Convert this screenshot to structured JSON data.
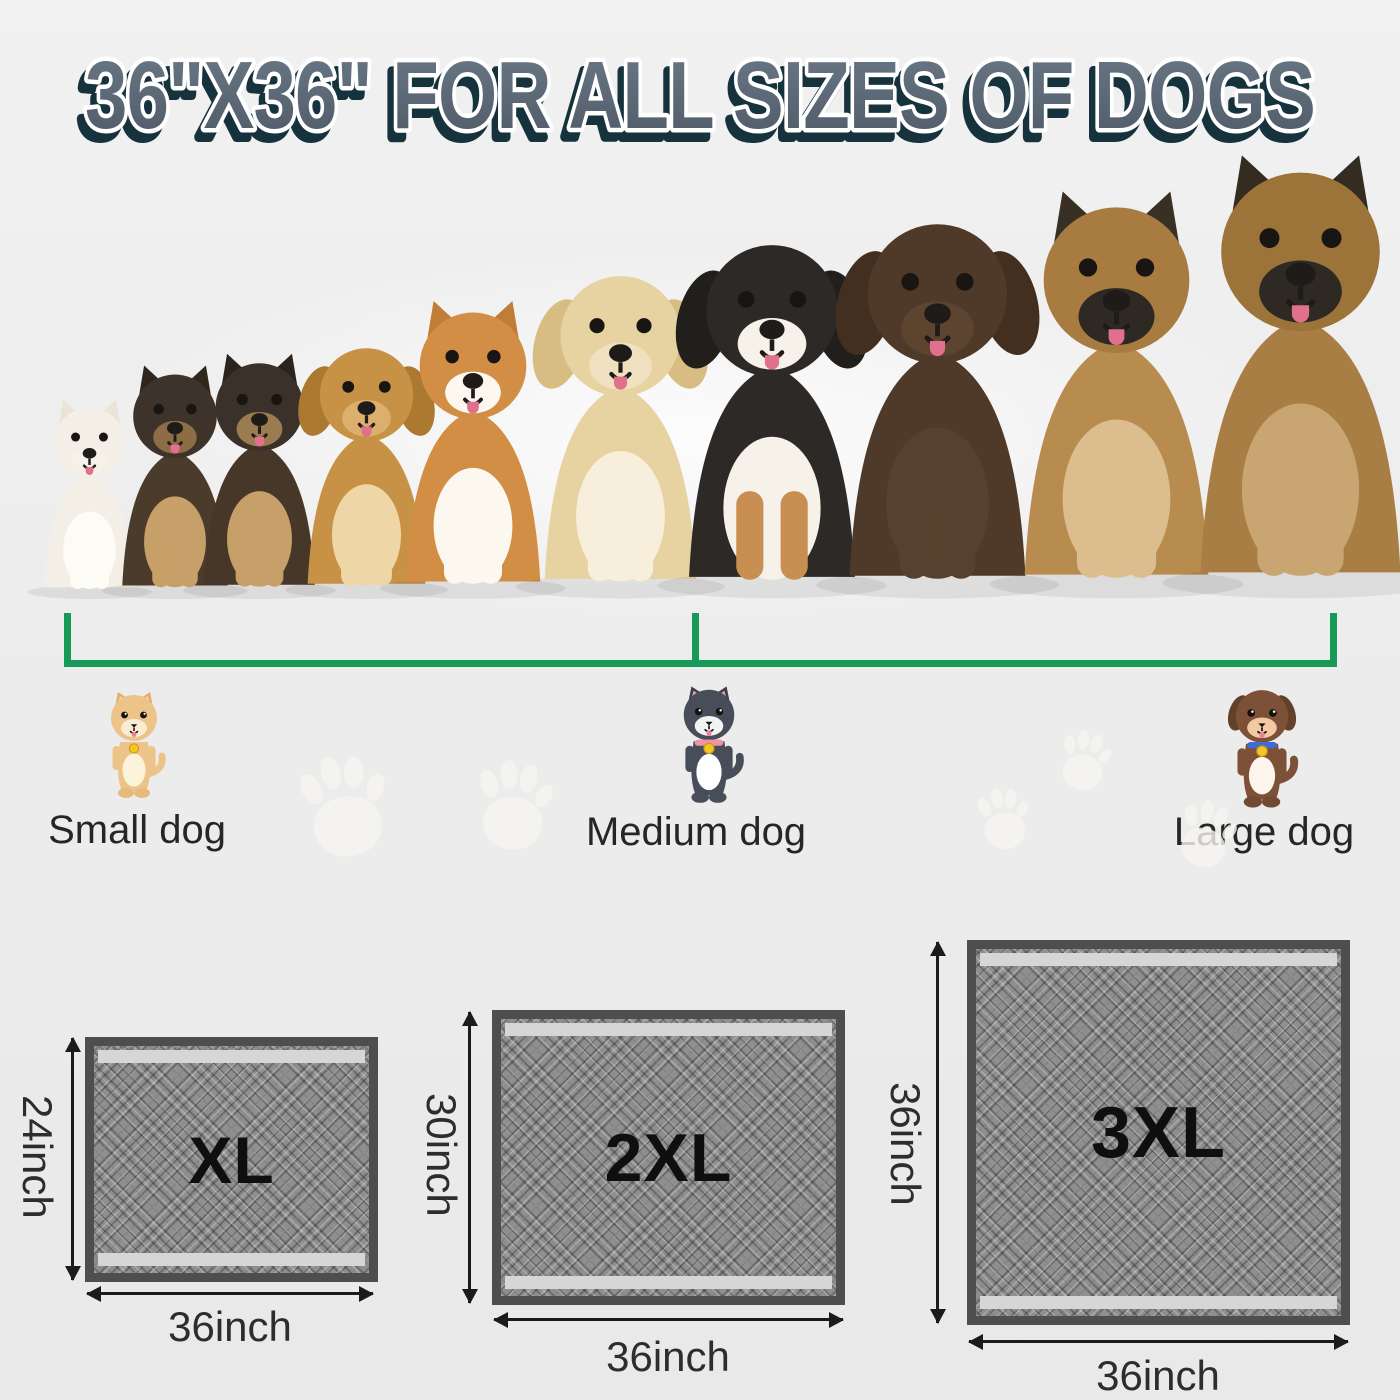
{
  "title": "36\"X36\" FOR ALL SIZES OF DOGS",
  "colors": {
    "background": "#ededed",
    "title_fill": "#5a6775",
    "title_shadow": "#16333d",
    "title_outline": "#ffffff",
    "bracket_green": "#169a58",
    "label_text": "#262626",
    "dimension_text": "#2d2d2d",
    "arrow_color": "#1b1b1b",
    "pad_border": "#4e4e4e",
    "pad_field": "#8f8f8f",
    "pad_strip": "#d6d6d6",
    "size_label_text": "#0f0f0f",
    "paw_print": "#f8f5f0"
  },
  "size_categories": [
    {
      "label": "Small dog",
      "icon": {
        "name": "small-dog-icon",
        "ear": "pointy",
        "body": "#ecc489",
        "belly": "#fdf3da",
        "ear_color": "#e2ae6c",
        "ear_inner": "#f6cfa0",
        "muzzle": "#f9ecd2",
        "collar": "",
        "tag": "#f5c525",
        "feet": "#e6ba7b"
      }
    },
    {
      "label": "Medium dog",
      "icon": {
        "name": "medium-dog-icon",
        "ear": "pointy",
        "body": "#474d59",
        "belly": "#ffffff",
        "ear_color": "#3b404b",
        "ear_inner": "#f59a9a",
        "muzzle": "#f2f3f5",
        "collar": "#f293a4",
        "tag": "#f5c525",
        "feet": "#474d59"
      }
    },
    {
      "label": "Large dog",
      "icon": {
        "name": "large-dog-icon",
        "ear": "floppy",
        "body": "#7d5137",
        "belly": "#fdf5ec",
        "ear_color": "#63402a",
        "ear_inner": "",
        "muzzle": "#f2c9a2",
        "collar": "#3f6bd6",
        "tag": "#f5c525",
        "feet": "#714a31"
      }
    }
  ],
  "hero_dogs": [
    {
      "name": "white-puppy-photo",
      "ear": "pointy",
      "height_px": 205,
      "center_x": 89,
      "colors": {
        "body": "#f4efe6",
        "chest": "#fdfbf5",
        "head": "#f4efe6",
        "ear": "#eae3d6",
        "muzzle": "#f6f1e8",
        "leg": "#fdfbf5"
      }
    },
    {
      "name": "shepherd-puppy-photo",
      "ear": "pointy",
      "height_px": 240,
      "center_x": 175,
      "colors": {
        "body": "#4b3b2a",
        "chest": "#c7a069",
        "head": "#3e332a",
        "ear": "#2f261d",
        "muzzle": "#8c6d45",
        "leg": "#c7a069"
      }
    },
    {
      "name": "shepherd-puppy-2-photo",
      "ear": "pointy",
      "height_px": 252,
      "center_x": 259,
      "colors": {
        "body": "#463729",
        "chest": "#c7a069",
        "head": "#3a312a",
        "ear": "#2c241c",
        "muzzle": "#9b7c50",
        "leg": "#c7a069"
      }
    },
    {
      "name": "cocker-spaniel-photo",
      "ear": "floppy",
      "height_px": 268,
      "center_x": 366,
      "colors": {
        "body": "#c79245",
        "chest": "#eed6a6",
        "head": "#c79245",
        "ear": "#ab7a30",
        "muzzle": "#dcb06c",
        "leg": "#eed6a6"
      }
    },
    {
      "name": "corgi-photo",
      "ear": "pointy",
      "height_px": 306,
      "center_x": 473,
      "colors": {
        "body": "#d28e45",
        "chest": "#fcf8ef",
        "head": "#d28e45",
        "ear": "#bf7d37",
        "muzzle": "#fcf8ef",
        "leg": "#fcf8ef"
      }
    },
    {
      "name": "golden-retriever-photo",
      "ear": "floppy",
      "height_px": 345,
      "center_x": 620,
      "colors": {
        "body": "#e7d2a2",
        "chest": "#f7efdb",
        "head": "#e7d2a2",
        "ear": "#d8bd83",
        "muzzle": "#efe1bf",
        "leg": "#f7efdb"
      }
    },
    {
      "name": "bernese-mountain-dog-photo",
      "ear": "floppy",
      "height_px": 378,
      "center_x": 772,
      "colors": {
        "body": "#2c2926",
        "chest": "#f6f2ea",
        "head": "#2c2926",
        "ear": "#211f1b",
        "muzzle": "#f6f2ea",
        "leg": "#c98f52"
      }
    },
    {
      "name": "chocolate-labrador-photo",
      "ear": "floppy",
      "height_px": 400,
      "center_x": 937,
      "colors": {
        "body": "#4f3929",
        "chest": "#57402d",
        "head": "#4f3929",
        "ear": "#432f1f",
        "muzzle": "#5c442f",
        "leg": "#57402d"
      }
    },
    {
      "name": "german-shepherd-photo",
      "ear": "pointy",
      "height_px": 418,
      "center_x": 1116,
      "colors": {
        "body": "#b88b4e",
        "chest": "#dcbd8d",
        "head": "#a87c41",
        "ear": "#393025",
        "muzzle": "#2e2a23",
        "leg": "#dcbd8d"
      }
    },
    {
      "name": "german-shepherd-2-photo",
      "ear": "pointy",
      "height_px": 455,
      "center_x": 1300,
      "colors": {
        "body": "#a97e44",
        "chest": "#c9a572",
        "head": "#9c7338",
        "ear": "#342b21",
        "muzzle": "#2e2a23",
        "leg": "#c9a572"
      }
    }
  ],
  "paw_prints": [
    {
      "x": 285,
      "y": 745,
      "size": 120,
      "rotate": -8
    },
    {
      "x": 462,
      "y": 752,
      "size": 105,
      "rotate": 6
    },
    {
      "x": 1050,
      "y": 725,
      "size": 70,
      "rotate": 12
    },
    {
      "x": 968,
      "y": 782,
      "size": 72,
      "rotate": -4
    },
    {
      "x": 1168,
      "y": 795,
      "size": 78,
      "rotate": 16
    }
  ],
  "pads": [
    {
      "size_label": "XL",
      "height_label": "24inch",
      "width_label": "36inch"
    },
    {
      "size_label": "2XL",
      "height_label": "30inch",
      "width_label": "36inch"
    },
    {
      "size_label": "3XL",
      "height_label": "36inch",
      "width_label": "36inch"
    }
  ]
}
